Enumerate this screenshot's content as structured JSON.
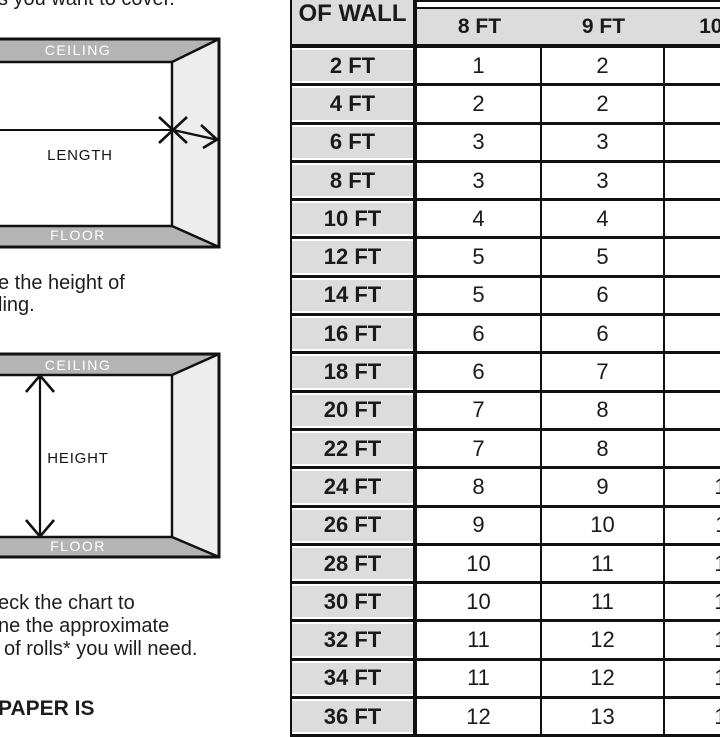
{
  "colors": {
    "background": "#ffffff",
    "table_cell_gray": "#dcdcdc",
    "ceiling_floor_band_gray": "#b4b4b4",
    "side_wall_gray": "#ededed",
    "line_black": "#111111"
  },
  "left_panel": {
    "top_fragment": "s you want to cover.",
    "length_diagram": {
      "ceiling": "CEILING",
      "floor": "FLOOR",
      "label": "LENGTH"
    },
    "mid_fragment": {
      "line1": "e the height of",
      "line2": "ling."
    },
    "height_diagram": {
      "ceiling": "CEILING",
      "floor": "FLOOR",
      "label": "HEIGHT"
    },
    "note_fragment": {
      "line1": "eck the chart to",
      "line2": "ne the approximate",
      "line3": "of rolls* you will need."
    },
    "heading_fragment": "PAPER IS"
  },
  "chart_data": {
    "type": "table",
    "row_header_fragment": "OF WALL",
    "columns": [
      "8 FT",
      "9 FT",
      "10 FT"
    ],
    "rows": [
      {
        "label": "2 FT",
        "values": [
          1,
          2,
          2
        ]
      },
      {
        "label": "4 FT",
        "values": [
          2,
          2,
          2
        ]
      },
      {
        "label": "6 FT",
        "values": [
          3,
          3,
          3
        ]
      },
      {
        "label": "8 FT",
        "values": [
          3,
          3,
          4
        ]
      },
      {
        "label": "10 FT",
        "values": [
          4,
          4,
          5
        ]
      },
      {
        "label": "12 FT",
        "values": [
          5,
          5,
          6
        ]
      },
      {
        "label": "14 FT",
        "values": [
          5,
          6,
          6
        ]
      },
      {
        "label": "16 FT",
        "values": [
          6,
          6,
          7
        ]
      },
      {
        "label": "18 FT",
        "values": [
          6,
          7,
          8
        ]
      },
      {
        "label": "20 FT",
        "values": [
          7,
          8,
          9
        ]
      },
      {
        "label": "22 FT",
        "values": [
          7,
          8,
          9
        ]
      },
      {
        "label": "24 FT",
        "values": [
          8,
          9,
          10
        ]
      },
      {
        "label": "26 FT",
        "values": [
          9,
          10,
          11
        ]
      },
      {
        "label": "28 FT",
        "values": [
          10,
          11,
          12
        ]
      },
      {
        "label": "30 FT",
        "values": [
          10,
          11,
          12
        ]
      },
      {
        "label": "32 FT",
        "values": [
          11,
          12,
          13
        ]
      },
      {
        "label": "34 FT",
        "values": [
          11,
          12,
          13
        ]
      },
      {
        "label": "36 FT",
        "values": [
          12,
          13,
          14
        ]
      }
    ]
  }
}
